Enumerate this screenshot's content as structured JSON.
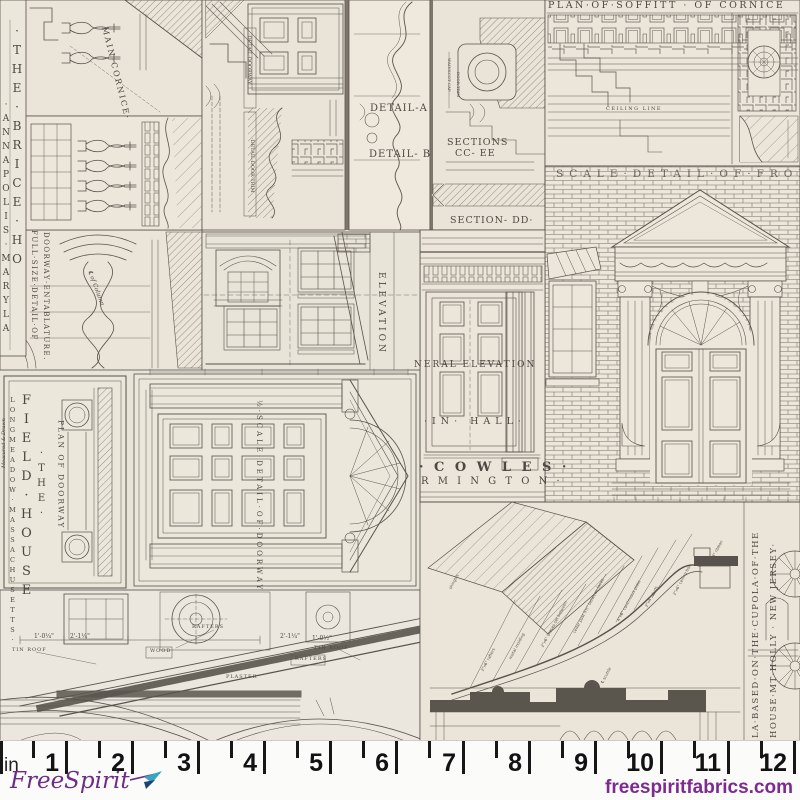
{
  "drawings": {
    "brice": {
      "title_col_inner": "·THE·BRICE·HO",
      "title_col_outer": "·ANNAPOLIS·MARYLA",
      "main_cornice": "MAIN·CORNICE·",
      "full_size_line1": "FULL·SIZE·DETAIL·OF",
      "full_size_line2": "DOORWAY·ENTABLATURE.",
      "cl_of_column": "℄ of Column"
    },
    "trim_details": {
      "detail_a": "DETAIL-A",
      "detail_b": "DETAIL- B",
      "sections_line1": "SECTIONS",
      "sections_line2": "CC- EE",
      "section_dd": "SECTION- DD·",
      "wainscot_cap": "WAINSCOT CAP",
      "door_trim": "DOOR TRIM",
      "detail_doorway": "·DETAIL·DOORWAY",
      "detail_door_trim": "·DETAIL·DOOR·TRIM"
    },
    "soffit_plan": {
      "title": "PLAN·OF·SOFFITT · OF CORNICE",
      "ceiling_line": "CEILING LINE"
    },
    "front_detail": {
      "title": "SCALE·DETAIL·OF·FRONT"
    },
    "cowles": {
      "general_elevation": "NERAL ELEVATION",
      "main_hall": "·IN· HALL·",
      "name": "· C O W L E S ·",
      "town": "R M I N G T O N ·",
      "elevation": "ELEVATION"
    },
    "field_house": {
      "the": "·THE·",
      "name": "FIELD·HOUSE",
      "town": "LONGMEADOW·MASSACHUSETTS·",
      "credit": "Measured & Drawn",
      "plan_of_doorway": "PLAN OF DOORWAY",
      "half_scale": "½·SCALE·DETAIL·OF·DOORWAY"
    },
    "pediment_section": {
      "tin_roof_left": "TIN ROOF",
      "tin_roof_right": "TIN ROOF",
      "rafters_left": "RAFTERS",
      "rafters_right": "RAFTERS",
      "wood": "WOOD",
      "plaster": "PLASTER",
      "dim_1": "1'-0¼\"",
      "dim_2": "2'-1¼\"",
      "dim_3": "2'-1¼\"",
      "dim_4": "1'-0½\""
    },
    "cupola": {
      "title_line1": "LA·BASED·ON·THE·CUPOLA·OF·THE",
      "title_line2": "HOUSE·MT·HOLLY · NEW JERSEY·",
      "notes": [
        "1\"x8\" ribbon",
        "2\"x6\" ceiling box",
        "2\"x4\" studs",
        "4\"x6\" continuous plate",
        "cedar post 5½\" between faces",
        "2\"x6\" braces set between",
        "metal molding",
        "shingles",
        "℄ scuttle",
        "2\"x6\" rafters"
      ]
    }
  },
  "ruler": {
    "unit": "in",
    "numbers": [
      "1",
      "2",
      "3",
      "4",
      "5",
      "6",
      "7",
      "8",
      "9",
      "10",
      "11",
      "12"
    ]
  },
  "branding": {
    "logo_text": "FreeSpirit",
    "website": "freespiritfabrics.com"
  },
  "colors": {
    "paper": "#e9e4d8",
    "ink": "#57524b",
    "brand_purple": "#7d2b8f",
    "brand_teal": "#35a7c1"
  }
}
